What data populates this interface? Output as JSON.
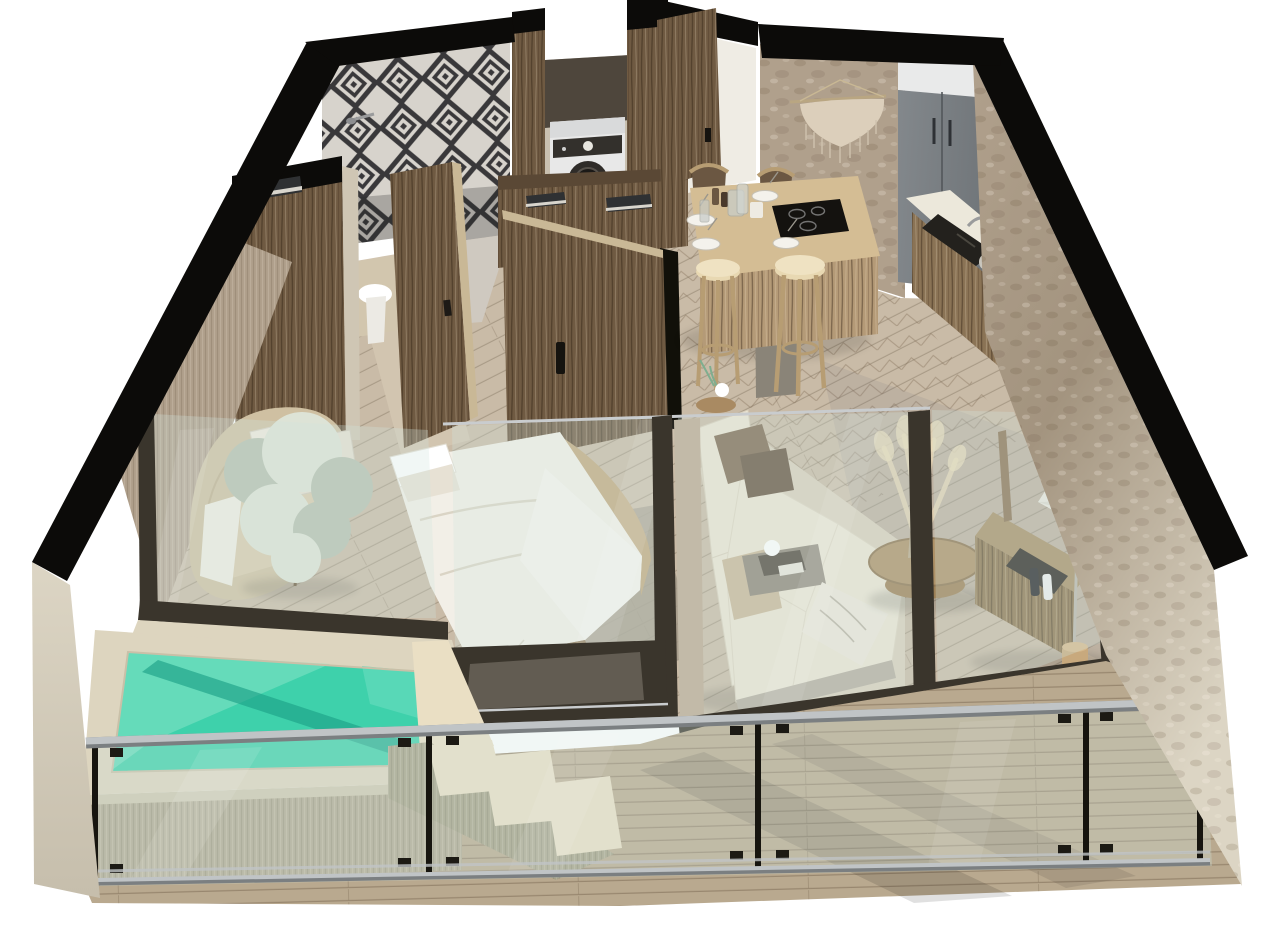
{
  "meta": {
    "title": "3D cutaway floor plan render of a one-bedroom apartment with plunge pool terrace",
    "view": "isometric dollhouse perspective, white background, walls cut showing black tops"
  },
  "colors": {
    "wallBlack": "#0c0b09",
    "extWall": "#dcd5c4",
    "extWallShade": "#c6beac",
    "stoneWall": "#b0a08c",
    "tileLight": "#d7d3cc",
    "tileDark": "#39383a",
    "woodDoor": "#6f5a42",
    "woodDoorDark": "#503e2c",
    "woodDoorLight": "#9a7f5c",
    "floorWood": "#c9bba7",
    "floorHall": "#d2c5b0",
    "deckWood": "#b9a98f",
    "pool": "#3ed1ab",
    "poolLight": "#85e4c7",
    "poolShade": "#1da287",
    "poolCoping": "#ddd5bf",
    "poolWallFace": "#b2aa93",
    "glassTint": "rgba(210,228,222,0.30)",
    "glassFrame": "#3a352c",
    "sofaCream": "#ebe4d3",
    "sofaShade": "#d8cfbc",
    "sofaBase": "#b5ada0",
    "pillowBrown": "#7d6851",
    "pillowBrown2": "#655240",
    "pillowTan": "#c9b799",
    "bedWhite": "#f2efe7",
    "bedShadow": "#dad4c5",
    "bedFrameTan": "#c2a87e",
    "headboardBeige": "#cfc0a2",
    "treeFoliage": "#b7c1b1",
    "treeFoliageLight": "#dde3d6",
    "rugGray": "#a19988",
    "islandTop": "#d4bd94",
    "islandSide": "#b49a77",
    "cooktop": "#14120f",
    "stoolSeat": "#e8d8b2",
    "stoolWood": "#b79d73",
    "counterMarble": "#ece8db",
    "sinkDark": "#23211d",
    "fridgeGray": "#71767a",
    "fridgeLight": "#e9eaea",
    "fridgeDark": "#1a1c1f",
    "lampShade": "#e9e6dd",
    "lampBase": "#c8a97d",
    "consoleWood": "#a78e66",
    "consoleFront": "#8d754f",
    "consoleDark": "#2c2823",
    "macrame": "#dccfbb",
    "washerWhite": "#e8e8e8",
    "washerDark": "#33302c",
    "stepStone": "#eadfc4",
    "stepSage": "#a6a289",
    "pampas": "#e3d3b4",
    "bookDark": "#2f3133",
    "railMetal": "#c0c4c6",
    "railMetalDark": "#7b7f81",
    "railPost": "#17150f"
  },
  "scene": {
    "rooms": [
      {
        "name": "bathroom",
        "objects": [
          "diamond-pattern-tile-wall",
          "shower-head",
          "vanity",
          "washbasin"
        ]
      },
      {
        "name": "laundry-closet",
        "objects": [
          "washing-machine"
        ]
      },
      {
        "name": "hallway",
        "objects": [
          "wood-wardrobe",
          "books-on-shelf",
          "open-wood-doors"
        ]
      },
      {
        "name": "kitchen",
        "objects": [
          "stone-accent-wall",
          "macrame-wall-hanging",
          "fridge",
          "marble-counter",
          "double-sink",
          "faucet",
          "tall-cabinet",
          "island-dining-table",
          "cooktop",
          "plates",
          "carafes",
          "dining-chairs",
          "bar-stools",
          "herringbone-floor"
        ]
      },
      {
        "name": "bedroom",
        "objects": [
          "curved-headboard",
          "pillows",
          "olive-tree",
          "double-bed",
          "white-duvet",
          "fringed-throw",
          "area-rug",
          "glazed-partition"
        ]
      },
      {
        "name": "living-room",
        "objects": [
          "sectional-sofa",
          "brown-pillows",
          "side-table-tray",
          "round-coffee-table",
          "pampas-grass-vase",
          "media-console",
          "bottles",
          "floor-lamp",
          "glass-facade",
          "round-accent-table"
        ]
      },
      {
        "name": "terrace",
        "objects": [
          "plunge-pool",
          "pool-coping",
          "wood-deck",
          "stone-steps",
          "glass-railing",
          "metal-handrail",
          "railing-clamps"
        ]
      }
    ]
  }
}
